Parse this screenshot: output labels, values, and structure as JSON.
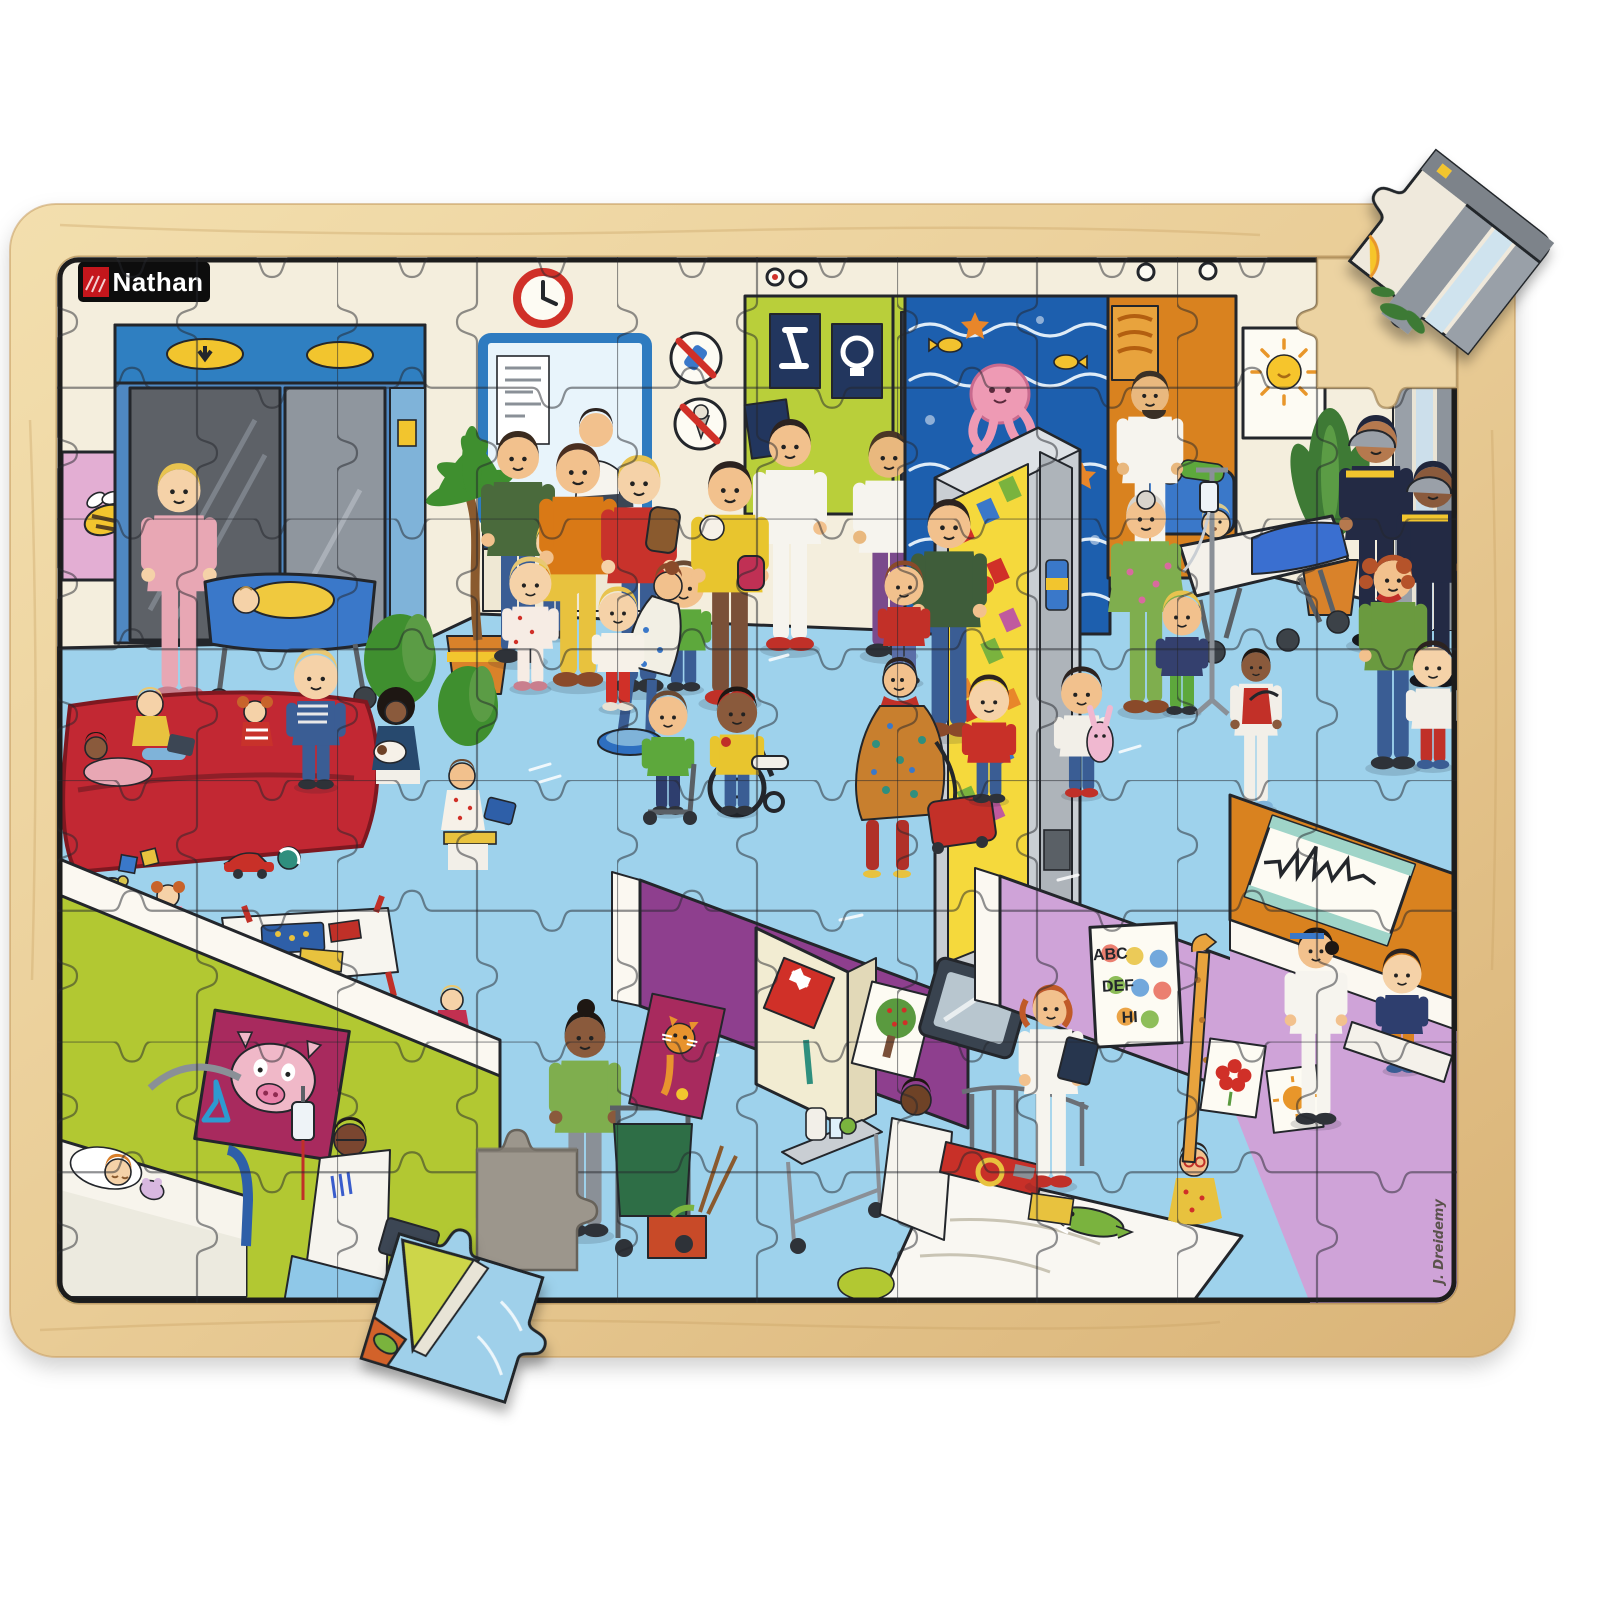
{
  "brand": {
    "name": "Nathan",
    "logo_bg": "#0d0d0d",
    "logo_accent": "#c4161c",
    "logo_text_color": "#ffffff"
  },
  "artist": {
    "signature": "J. Dreidemy",
    "color": "#5a524c"
  },
  "eye_chart": {
    "rows": [
      "ABC",
      "DEF",
      "HI"
    ]
  },
  "puzzle": {
    "board_material": "wood",
    "grid_cols": 10,
    "grid_rows": 8,
    "empty_slots": 2,
    "loose_pieces": 2,
    "loose_piece_positions": [
      "top-right-corner",
      "bottom-left-edge"
    ]
  },
  "palette": {
    "wood": "#eed8a6",
    "wood_dark": "#d6b077",
    "wall_cream": "#f4eedd",
    "floor_blue": "#9ed2ec",
    "mural_blue": "#1d5fae",
    "octopus_pink": "#ee9ab4",
    "lime_green": "#b9cf3a",
    "orange_room": "#d9821f",
    "purple_wall": "#8e3f8e",
    "lilac_wall": "#cfa3d8",
    "magenta_poster": "#a82a5e",
    "sofa_red": "#c22833",
    "frame_blue": "#2e7bc0",
    "cross_red": "#d03028"
  },
  "scene_elements": [
    "wooden-frame",
    "hospital-scene-print",
    "elevator",
    "bee-poster",
    "plate-stack",
    "nurse-with-bassinet",
    "wall-clock",
    "reception-window",
    "no-phone-sign",
    "no-icecream-sign",
    "xray-viewer-room",
    "wave-mural-octopus",
    "vending-machine",
    "exam-room-bearded-doctor",
    "sun-poster",
    "potted-plant",
    "firefighters-with-stretcher",
    "grandma-with-iv-pole",
    "pregnant-woman-with-suitcase",
    "child-in-wheelchair",
    "running-children",
    "waiting-area-red-sofa",
    "toys-on-floor",
    "play-table",
    "pig-poster",
    "child-hospital-bed",
    "doctor-at-desk",
    "cleaning-trolley",
    "medicine-cabinet",
    "cat-poster",
    "apple-tree-picture",
    "wall-tv",
    "meal-trolley",
    "girl-in-bed-with-crocodile",
    "nurse-with-clipboard",
    "eye-test-chart",
    "giraffe-measuring-stick",
    "children-drawings",
    "ecg-monitor",
    "doctor-examining-boy",
    "missing-piece-slot-top-right",
    "missing-piece-slot-bottom-left",
    "loose-piece-top-right",
    "loose-piece-bottom-left",
    "palm-tree",
    "brand-logo",
    "artist-signature"
  ]
}
